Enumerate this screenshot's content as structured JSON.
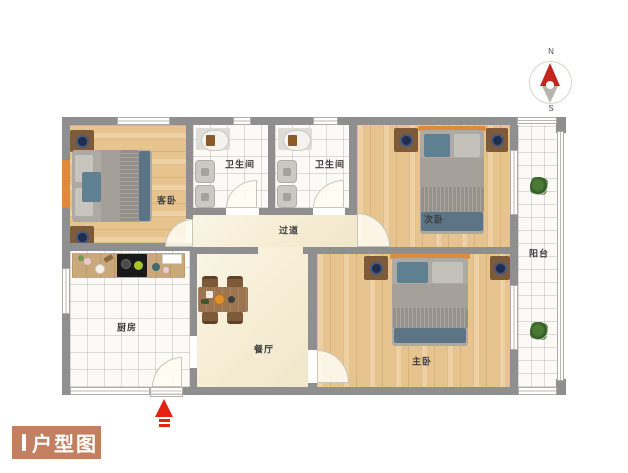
{
  "title": {
    "label": "户型图"
  },
  "compass": {
    "north": "N",
    "south": "S"
  },
  "rooms": {
    "guest_bedroom": "客卧",
    "bathroom_1": "卫生间",
    "bathroom_2": "卫生间",
    "second_bedroom": "次卧",
    "hallway": "过道",
    "kitchen": "厨房",
    "dining_room": "餐厅",
    "master_bedroom": "主卧",
    "balcony": "阳台"
  },
  "colors": {
    "wall": "#8f8f8f",
    "wood_floor": "#e7c48e",
    "cream_floor": "#f7efd8",
    "tile_floor": "#fbfaf6",
    "headboard_accent": "#dd8a3c",
    "title_box": "#c28061",
    "entrance_arrow": "#e42313",
    "compass_north": "#c3261d"
  }
}
